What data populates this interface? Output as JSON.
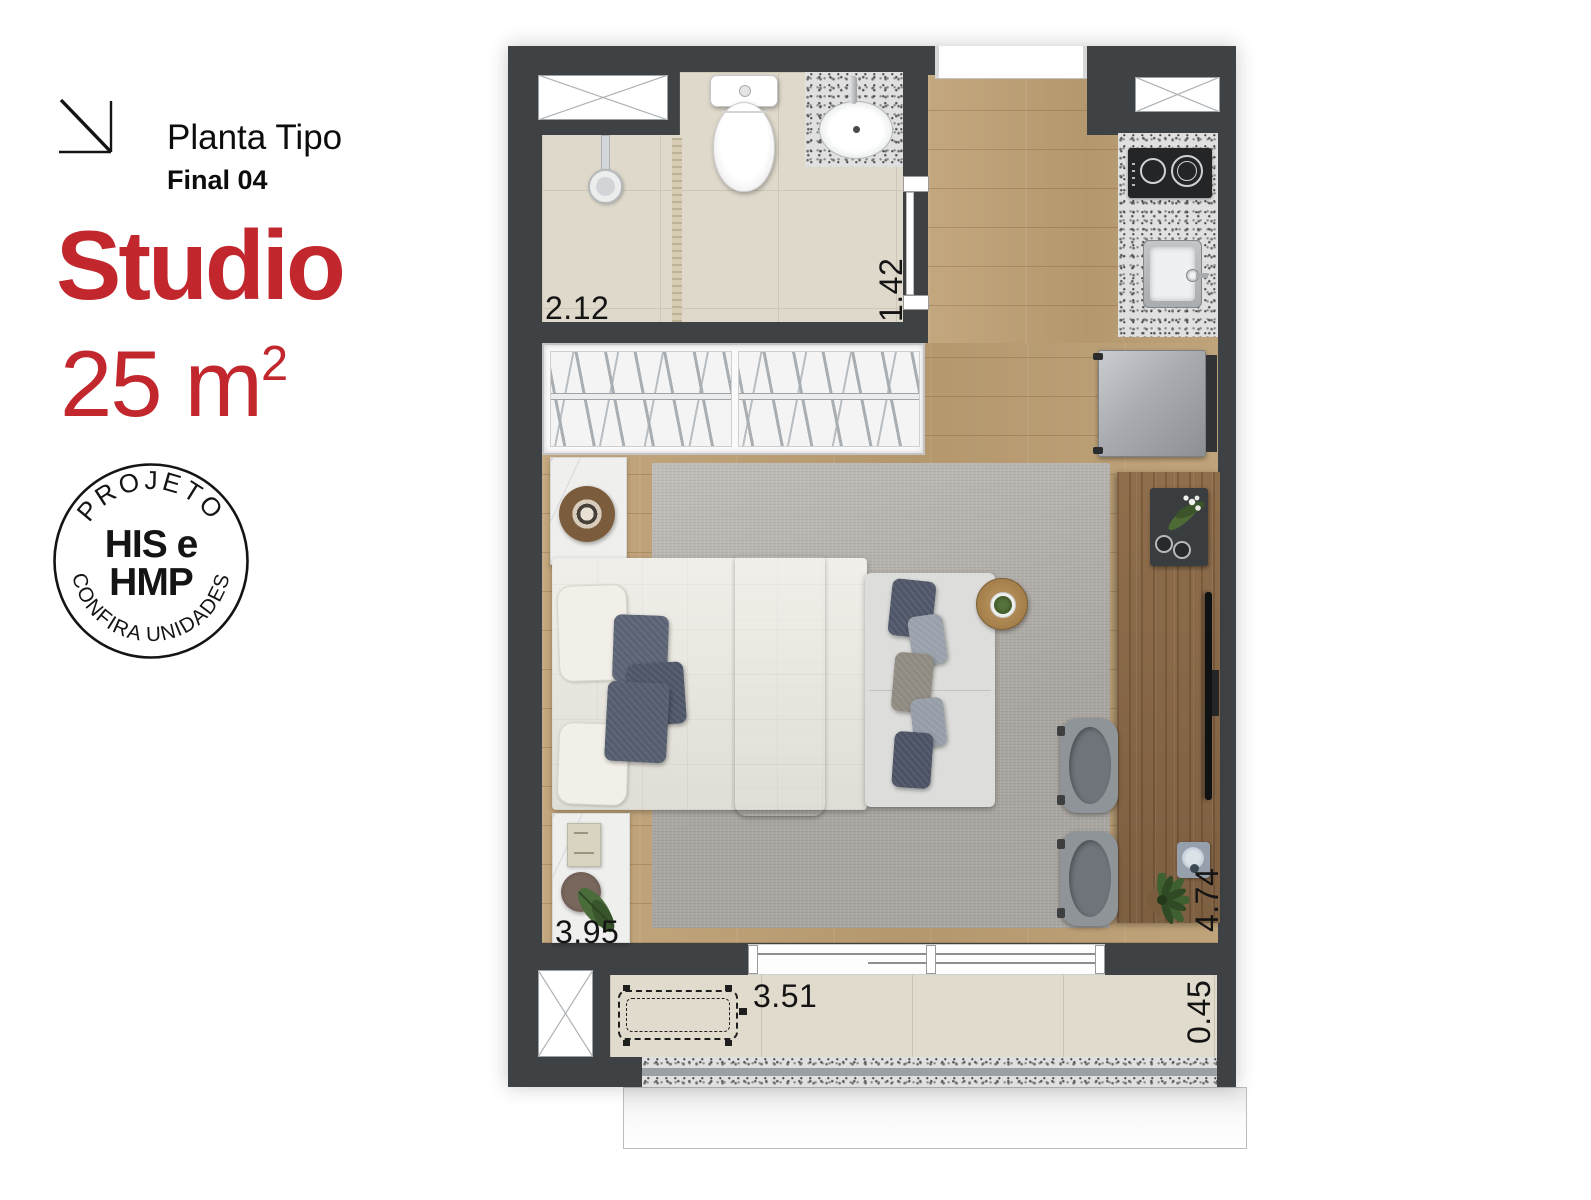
{
  "header": {
    "arrow_icon": "corner-arrow-icon",
    "plan_type": "Planta Tipo",
    "unit_final": "Final 04",
    "unit_type": "Studio",
    "area_value": "25 m",
    "area_exponent": "2"
  },
  "badge": {
    "top_text": "PROJETO",
    "center_line1": "HIS e",
    "center_line2": "HMP",
    "bottom_text": "CONFIRA UNIDADES"
  },
  "floorplan": {
    "dimensions": {
      "bathroom_width": "2.12",
      "hall_width": "1.42",
      "room_width": "3.95",
      "room_length": "4.74",
      "balcony_width": "3.51",
      "balcony_depth": "0.45"
    },
    "fixtures": [
      "duct-shaft",
      "shower",
      "toilet",
      "bathroom-sink",
      "door",
      "entry-opening",
      "duct-shaft",
      "cooktop",
      "kitchen-sink",
      "fridge",
      "wardrobe-hangers",
      "nightstand",
      "double-bed",
      "bed-runner",
      "sofa",
      "round-side-table",
      "desk-counter",
      "decor-tray",
      "tv",
      "stool",
      "stool",
      "plant",
      "balcony-bench",
      "duct-shaft",
      "window-sliding"
    ]
  },
  "colors": {
    "accent_red": "#c1272d",
    "wall": "#3f4245",
    "wood_light": "#bfa37b",
    "wood_dark": "#8a6a49",
    "tile": "#ded9cb",
    "rug": "#b5b1ac",
    "granite": "#e0e0e0",
    "pillow_navy": "#525a6c"
  }
}
